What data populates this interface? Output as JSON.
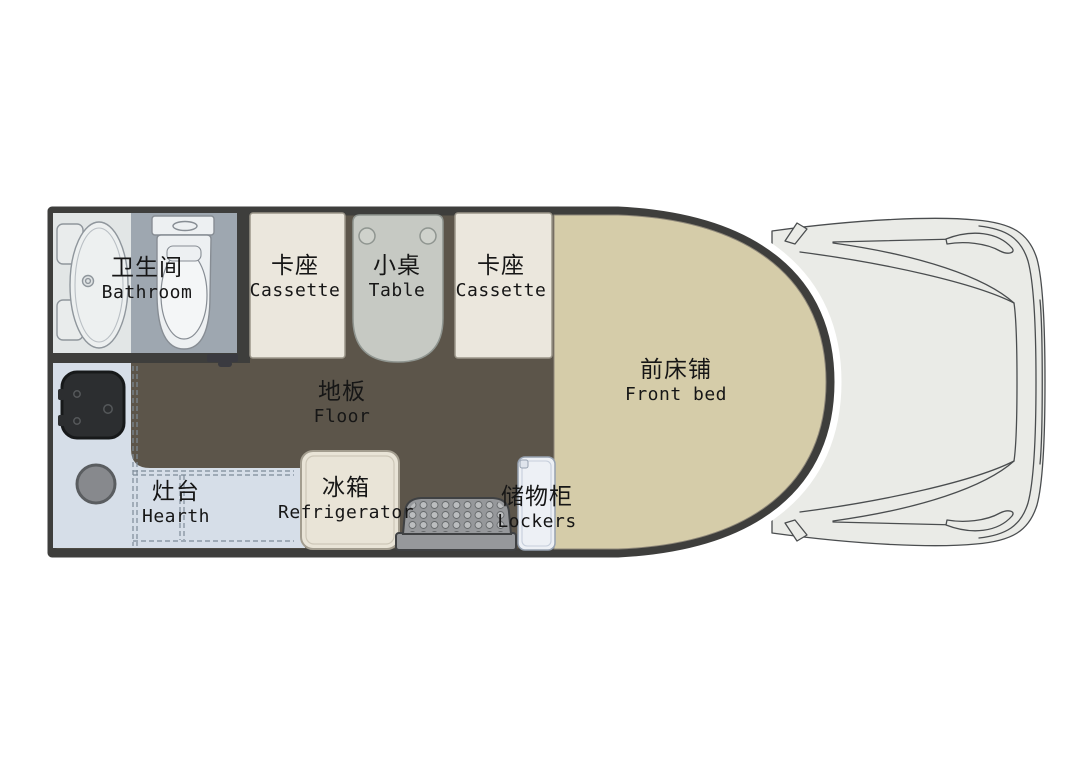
{
  "rooms": {
    "bathroom": {
      "zh": "卫生间",
      "en": "Bathroom"
    },
    "cassette_front": {
      "zh": "卡座",
      "en": "Cassette"
    },
    "table": {
      "zh": "小桌",
      "en": "Table"
    },
    "cassette_rear": {
      "zh": "卡座",
      "en": "Cassette"
    },
    "floor": {
      "zh": "地板",
      "en": "Floor"
    },
    "front_bed": {
      "zh": "前床铺",
      "en": "Front bed"
    },
    "hearth": {
      "zh": "灶台",
      "en": "Hearth"
    },
    "refrigerator": {
      "zh": "冰箱",
      "en": "Refrigerator"
    },
    "lockers": {
      "zh": "储物柜",
      "en": "Lockers"
    }
  },
  "palette": {
    "wall": "#3e3e3c",
    "floor": "#5c554a",
    "bed": "#d5cca9",
    "cassette": "#ebe7dd",
    "table": "#c6c9c3",
    "bathroom_light": "#e2e6e6",
    "bathroom_dark": "#9ea7b0",
    "counter": "#d6dee8",
    "fridge": "#e9e4d7",
    "lockers": "#edf0f5",
    "sink": "#2c2e30",
    "burner": "#87898d",
    "step": "#96989b",
    "cab_fill": "#eaebe7",
    "fixture_white": "#edf0f2"
  }
}
